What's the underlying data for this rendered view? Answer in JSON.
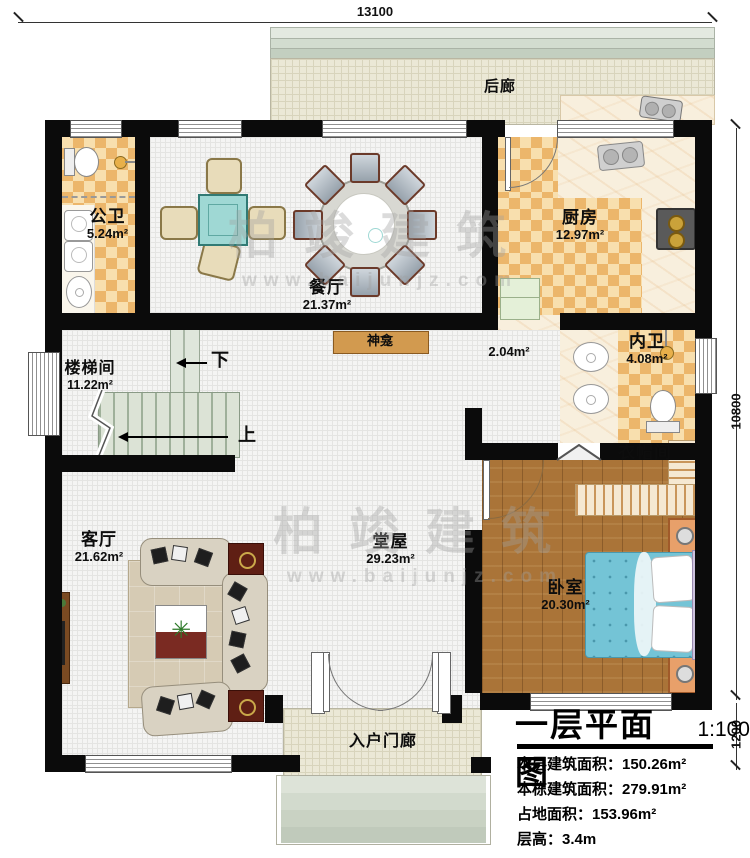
{
  "plan_title": "一层平面图",
  "plan_scale": "1:100",
  "titleblock": {
    "lines": [
      "本层建筑面积：150.26m²",
      "本栋建筑面积：279.91m²",
      "占地面积：153.96m²",
      "层高：3.4m"
    ]
  },
  "dimensions": {
    "top_width": "13100",
    "right_height_main": "10800",
    "right_height_porch": "1200"
  },
  "rooms": {
    "porch_back": {
      "name": "后廊",
      "area": ""
    },
    "public_bath": {
      "name": "公卫",
      "area": "5.24m²"
    },
    "dining": {
      "name": "餐厅",
      "area": "21.37m²"
    },
    "kitchen": {
      "name": "厨房",
      "area": "12.97m²"
    },
    "inner_bath": {
      "name": "内卫",
      "area": "4.08m²"
    },
    "stairwell": {
      "name": "楼梯间",
      "area": "11.22m²"
    },
    "shrine": {
      "name": "神龛",
      "area": ""
    },
    "corridor": {
      "name": "",
      "area": "2.04m²"
    },
    "cloakroom": {
      "name": "衣帽间",
      "area": ""
    },
    "living": {
      "name": "客厅",
      "area": "21.62m²"
    },
    "hall": {
      "name": "堂屋",
      "area": "29.23m²"
    },
    "bedroom": {
      "name": "卧室",
      "area": "20.30m²"
    },
    "porch_entry": {
      "name": "入户门廊",
      "area": ""
    }
  },
  "stairs": {
    "up": "上",
    "down": "下"
  },
  "watermark": {
    "brand": "柏竣建筑",
    "url": "www.baijunjz.com"
  },
  "colors": {
    "wall": "#0b0b0b",
    "checker_dark": "#ecb66b",
    "checker_light": "#f8dfae",
    "wood": "#aa7438",
    "marble": "#f8efdd",
    "bed": "#74c4d6",
    "stairs": "#dce3d6",
    "porch_floor": "#ebe8d6",
    "shrine_shelf": "#d29a4f",
    "table": "#9fd8d4"
  }
}
